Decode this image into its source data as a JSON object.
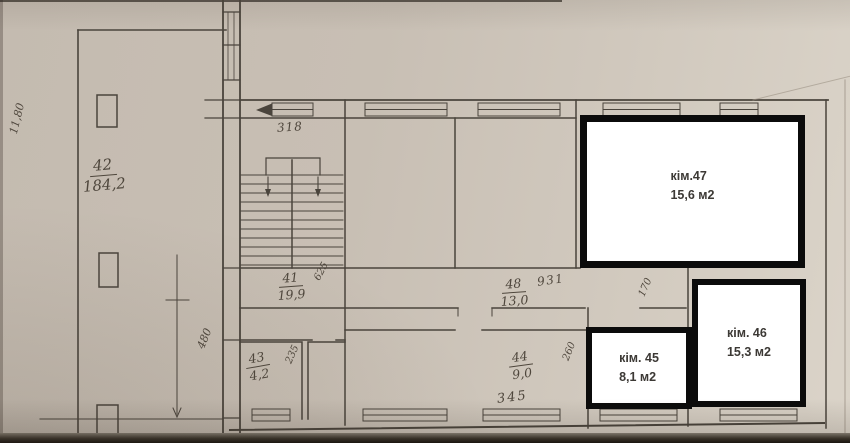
{
  "highlight_rooms": [
    {
      "name": "кім.47",
      "area": "15,6 м2"
    },
    {
      "name": "кім. 46",
      "area": "15,3 м2"
    },
    {
      "name": "кім. 45",
      "area": "8,1 м2"
    }
  ],
  "handwritten": {
    "room42": {
      "num": "42",
      "den": "184,2"
    },
    "dim_left_vertical": "11,80",
    "dim_318": "318",
    "room41": {
      "num": "41",
      "den": "19,9"
    },
    "dim_625": "625",
    "corridor48": {
      "num": "48",
      "den": "13,0"
    },
    "dim_931": "931",
    "dim_170": "170",
    "dim_480": "480",
    "room43": {
      "num": "43",
      "den": "4,2"
    },
    "dim_235": "235",
    "room44": {
      "num": "44",
      "den": "9,0"
    },
    "dim_260": "260",
    "dim_345": "345"
  },
  "colors": {
    "paper": "#c8bfb4",
    "ink": "#4a443c",
    "highlight_border": "#0b0b0b",
    "highlight_fill": "#ffffff",
    "label_text": "#3c3935"
  }
}
